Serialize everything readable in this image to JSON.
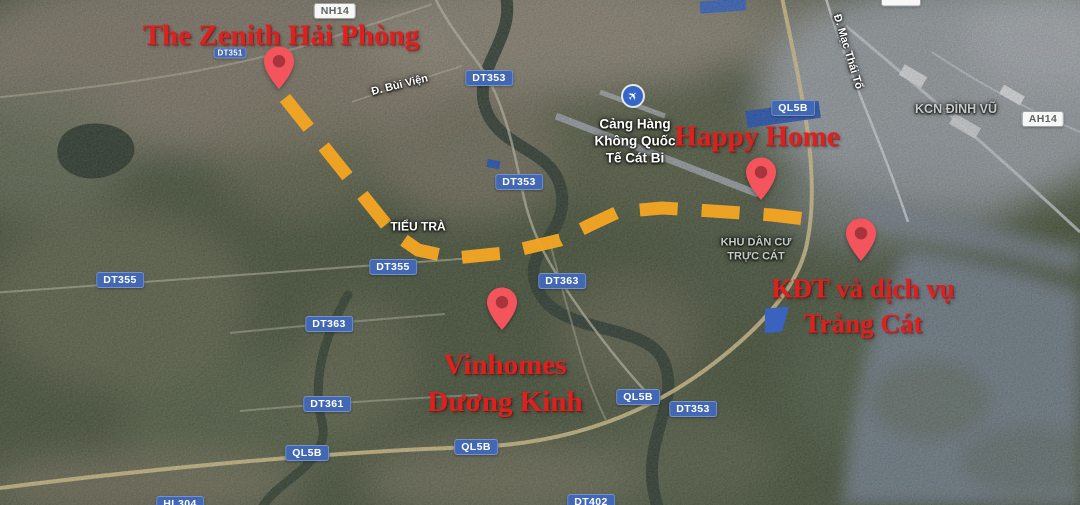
{
  "colors": {
    "accent_red": "#e0201f",
    "route_orange": "#f6a623",
    "badge_blue": "#4268b3",
    "badge_white_bg": "#f7f7f5",
    "pin_fill": "#f4555c",
    "pin_dot": "#a8343c",
    "flag_blue": "#3a63c0",
    "airport_icon_blue": "#3465c8"
  },
  "projects": [
    {
      "name": "the-zenith-hai-phong",
      "lines": [
        "The Zenith Hải Phòng"
      ],
      "x": 281,
      "y": 36,
      "font_size": 29,
      "marker": {
        "x": 279,
        "y": 96
      }
    },
    {
      "name": "happy-home",
      "lines": [
        "Happy Home"
      ],
      "x": 757,
      "y": 137,
      "font_size": 29,
      "marker": {
        "x": 761,
        "y": 207
      }
    },
    {
      "name": "vinhomes-duong-kinh",
      "lines": [
        "Vinhomes",
        "Dương Kinh"
      ],
      "x": 505,
      "y": 384,
      "font_size": 29,
      "marker": {
        "x": 502,
        "y": 337
      }
    },
    {
      "name": "kdt-va-dich-vu-trang-cat",
      "lines": [
        "KĐT và dịch vụ",
        "Tràng Cát"
      ],
      "x": 863,
      "y": 306,
      "font_size": 27,
      "marker": {
        "x": 861,
        "y": 268
      }
    }
  ],
  "road_badges": [
    {
      "text": "DT351",
      "x": 230,
      "y": 53,
      "style": "blue",
      "small": true
    },
    {
      "text": "DT353",
      "x": 489,
      "y": 78,
      "style": "blue"
    },
    {
      "text": "DT353",
      "x": 519,
      "y": 182,
      "style": "blue"
    },
    {
      "text": "DT355",
      "x": 120,
      "y": 280,
      "style": "blue"
    },
    {
      "text": "DT355",
      "x": 393,
      "y": 267,
      "style": "blue"
    },
    {
      "text": "DT363",
      "x": 562,
      "y": 281,
      "style": "blue"
    },
    {
      "text": "DT363",
      "x": 329,
      "y": 324,
      "style": "blue"
    },
    {
      "text": "DT361",
      "x": 327,
      "y": 404,
      "style": "blue"
    },
    {
      "text": "QL5B",
      "x": 307,
      "y": 453,
      "style": "blue"
    },
    {
      "text": "QL5B",
      "x": 476,
      "y": 447,
      "style": "blue"
    },
    {
      "text": "QL5B",
      "x": 638,
      "y": 397,
      "style": "blue"
    },
    {
      "text": "DT353",
      "x": 693,
      "y": 409,
      "style": "blue"
    },
    {
      "text": "QL5B",
      "x": 793,
      "y": 108,
      "style": "blue"
    },
    {
      "text": "DT402",
      "x": 591,
      "y": 502,
      "style": "blue"
    },
    {
      "text": "HL304",
      "x": 180,
      "y": 504,
      "style": "blue"
    },
    {
      "text": "NH14",
      "x": 335,
      "y": 11,
      "style": "white"
    },
    {
      "text": "AH14",
      "x": 1043,
      "y": 119,
      "style": "white"
    },
    {
      "text": "",
      "x": 901,
      "y": 1,
      "style": "white frag"
    }
  ],
  "place_labels": [
    {
      "name": "street-label-bui-vien",
      "lines": [
        "Đ. Bùi Viện"
      ],
      "x": 400,
      "y": 86,
      "rotate": -14,
      "size": 11,
      "tone": "light"
    },
    {
      "name": "street-label-mac-thai-to",
      "lines": [
        "Đ. Mạc Thái Tổ"
      ],
      "x": 847,
      "y": 52,
      "rotate": 73,
      "size": 11,
      "tone": "light"
    },
    {
      "name": "area-label-tieu-tra",
      "lines": [
        "TIỂU TRÀ"
      ],
      "x": 418,
      "y": 227,
      "rotate": 0,
      "size": 12,
      "tone": "light"
    },
    {
      "name": "area-label-khu-dan-cu-truc-cat",
      "lines": [
        "KHU DÂN CƯ",
        "TRỰC CÁT"
      ],
      "x": 756,
      "y": 250,
      "rotate": 0,
      "size": 11,
      "tone": "muted"
    },
    {
      "name": "area-label-kcn-dinh-vu",
      "lines": [
        "KCN ĐÌNH VŨ"
      ],
      "x": 956,
      "y": 110,
      "rotate": 0,
      "size": 12.5,
      "tone": "muted"
    }
  ],
  "airport": {
    "name": "cat-bi-airport",
    "lines": [
      "Cảng Hàng",
      "Không Quốc",
      "Tế Cát Bi"
    ],
    "x": 635,
    "y": 142,
    "size": 13.5,
    "icon": {
      "x": 633,
      "y": 96
    }
  },
  "route": {
    "points": "285,98 392,232 418,250 455,258 505,253 560,240 590,225 618,212 662,208 712,211 772,215 822,221",
    "width": 13,
    "dash": "38 24",
    "color": "#f6a623"
  },
  "flag": {
    "x": 777,
    "y": 320
  }
}
